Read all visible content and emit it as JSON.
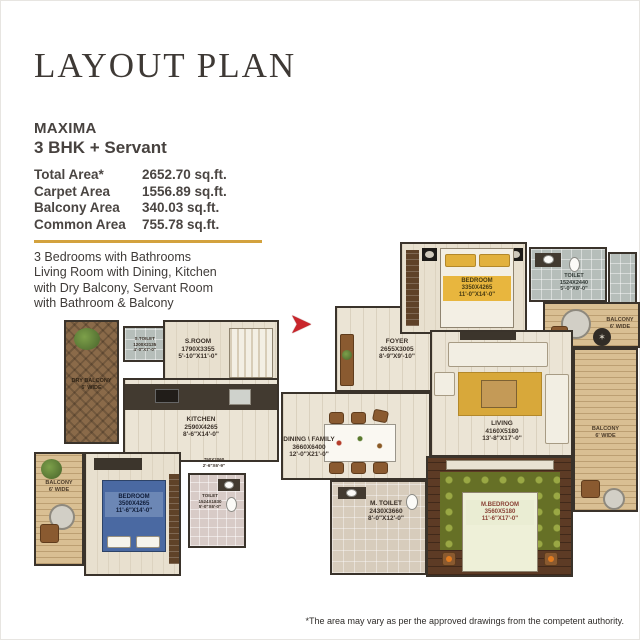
{
  "page": {
    "title": "LAYOUT PLAN",
    "disclaimer": "*The area may vary as per the approved drawings from the competent authority."
  },
  "unit": {
    "name": "MAXIMA",
    "config": "3 BHK + Servant",
    "areas": [
      {
        "label": "Total Area*",
        "value": "2652.70 sq.ft."
      },
      {
        "label": "Carpet Area",
        "value": "1556.89 sq.ft."
      },
      {
        "label": "Balcony Area",
        "value": "340.03 sq.ft."
      },
      {
        "label": "Common Area",
        "value": "755.78 sq.ft."
      }
    ],
    "description": [
      "3 Bedrooms with Bathrooms",
      "Living Room with Dining, Kitchen",
      "with Dry Balcony, Servant Room",
      "with Bathroom & Balcony"
    ]
  },
  "colors": {
    "accent": "#d3a23e",
    "entry_arrow": "#c9252b",
    "wall": "#3a332b"
  },
  "icons": {
    "entry_arrow": "➤",
    "compass": "✶"
  },
  "rooms": {
    "bedroom_top": {
      "name": "BEDROOM",
      "mm": "3350X4265",
      "ft": "11'-0\"X14'-0\""
    },
    "toilet_top": {
      "name": "TOILET",
      "mm": "1524X2440",
      "ft": "5'-0\"X8'-0\""
    },
    "balcony_top_right": {
      "name": "BALCONY",
      "wide": "6' WIDE"
    },
    "foyer": {
      "name": "FOYER",
      "mm": "2655X3005",
      "ft": "8'-9\"X9'-10\""
    },
    "living": {
      "name": "LIVING",
      "mm": "4160X5180",
      "ft": "13'-8\"X17'-0\""
    },
    "balcony_right": {
      "name": "BALCONY",
      "wide": "6' WIDE"
    },
    "dining": {
      "name": "DINING \\ FAMILY",
      "mm": "3660X6400",
      "ft": "12'-0\"X21'-0\""
    },
    "m_toilet": {
      "name": "M. TOILET",
      "mm": "2430X3660",
      "ft": "8'-0\"X12'-0\""
    },
    "m_bedroom": {
      "name": "M.BEDROOM",
      "mm": "3560X5180",
      "ft": "11'-6\"X17'-0\""
    },
    "s_room": {
      "name": "S.ROOM",
      "mm": "1790X3355",
      "ft": "5'-10\"X11'-0\""
    },
    "s_toilet": {
      "name": "S.TOILET",
      "mm": "1200X2135",
      "ft": "4'-0\"X7'-0\""
    },
    "dry_balcony": {
      "name": "DRY BALCONY",
      "wide": "6' WIDE"
    },
    "kitchen": {
      "name": "KITCHEN",
      "mm": "2590X4265",
      "ft": "8'-6\"X14'-0\""
    },
    "balcony_bottom_left": {
      "name": "BALCONY",
      "wide": "6' WIDE"
    },
    "bedroom_bottom": {
      "name": "BEDROOM",
      "mm": "3500X4265",
      "ft": "11'-6\"X14'-0\""
    },
    "toilet_bottom": {
      "name": "TOILET",
      "mm": "1524X1830",
      "ft": "5'-0\"X6'-0\""
    },
    "passage": {
      "mm": "750X2060",
      "ft": "2'-6\"X6'-9\""
    }
  }
}
